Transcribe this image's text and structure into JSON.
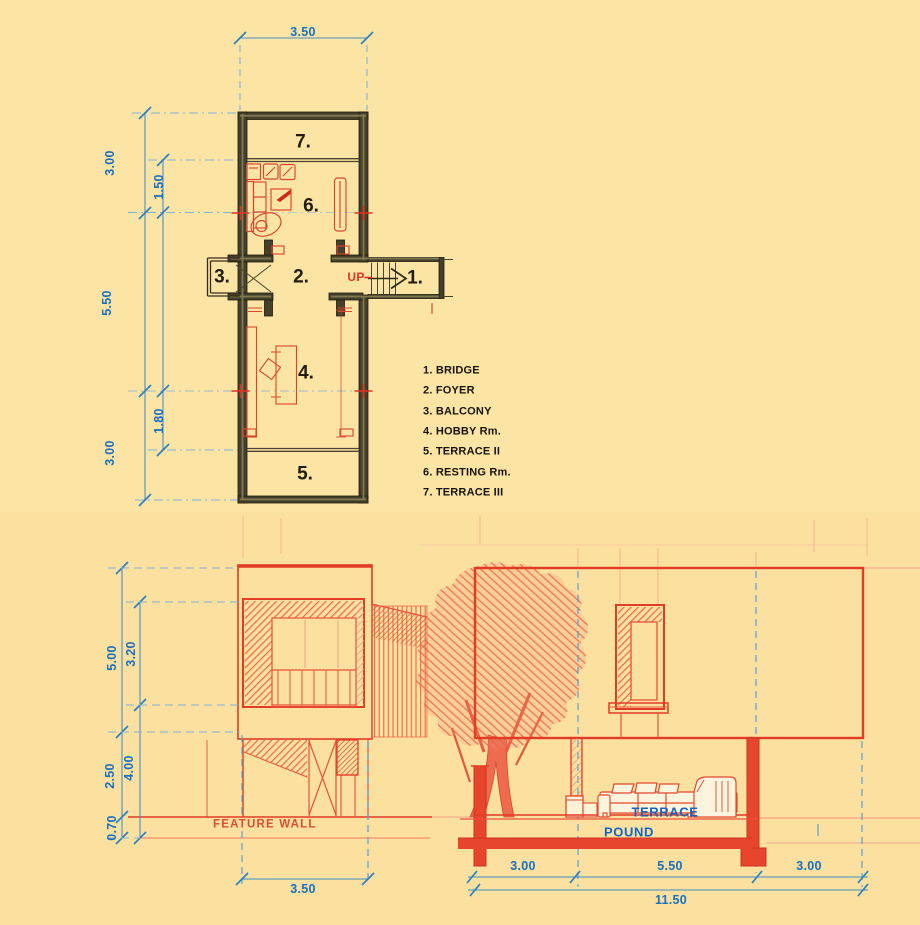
{
  "plan": {
    "dim_top": "3.50",
    "dims_left_outer": [
      "3.00",
      "5.50",
      "3.00"
    ],
    "dims_left_inner": [
      "1.50",
      "1.80"
    ],
    "rooms": {
      "terrace3": "7.",
      "resting": "6.",
      "balcony": "3.",
      "foyer": "2.",
      "bridge": "1.",
      "hobby": "4.",
      "terrace2": "5."
    },
    "up_label": "UP",
    "legend": [
      "1. BRIDGE",
      "2. FOYER",
      "3. BALCONY",
      "4. HOBBY Rm.",
      "5. TERRACE II",
      "6. RESTING Rm.",
      "7. TERRACE III"
    ]
  },
  "section": {
    "dims_left_outer": [
      "5.00",
      "2.50",
      "0.70"
    ],
    "dims_left_inner": [
      "3.20",
      "4.00"
    ],
    "dim_upper_width": "3.50",
    "dims_bottom": [
      "3.00",
      "5.50",
      "3.00"
    ],
    "dim_total": "11.50",
    "labels": {
      "feature_wall": "FEATURE WALL",
      "terrace": "TERRACE",
      "pound": "POUND"
    }
  },
  "colors": {
    "background": "#fce4a5",
    "dimension_blue": "#1a6fc0",
    "sketch_red": "#e23b26",
    "wall_dark": "#44402c",
    "label_blue": "#1565c0"
  }
}
